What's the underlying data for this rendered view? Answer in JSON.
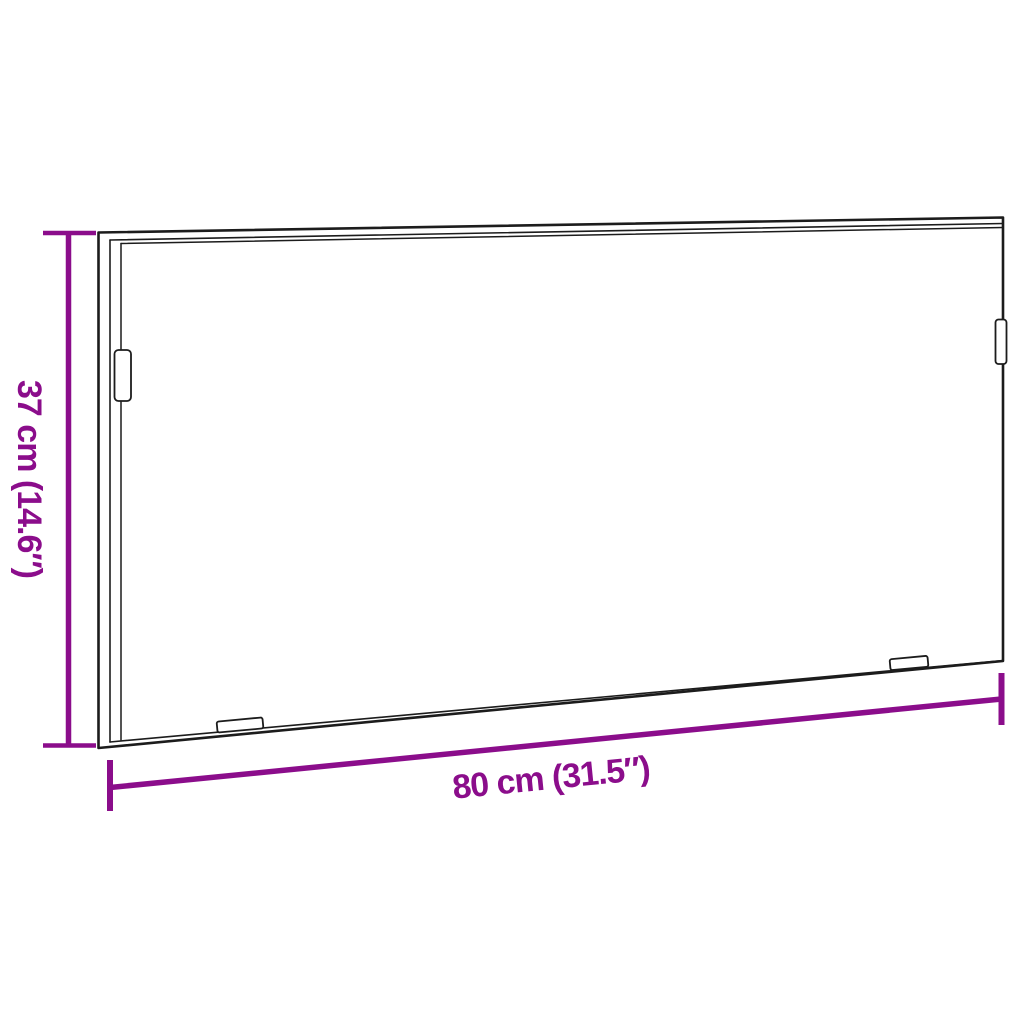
{
  "diagram": {
    "kind": "product-dimension-diagram",
    "object": "rectangular-frame"
  },
  "dimensions": {
    "height": {
      "label": "37 cm (14.6″)",
      "value_cm": "37",
      "value_in": "14.6"
    },
    "width": {
      "label": "80 cm (31.5″)",
      "value_cm": "80",
      "value_in": "31.5"
    }
  },
  "colors": {
    "dim_accent": "#8B0D8B",
    "outline": "#1C1C1C",
    "background": "#FFFFFF"
  }
}
